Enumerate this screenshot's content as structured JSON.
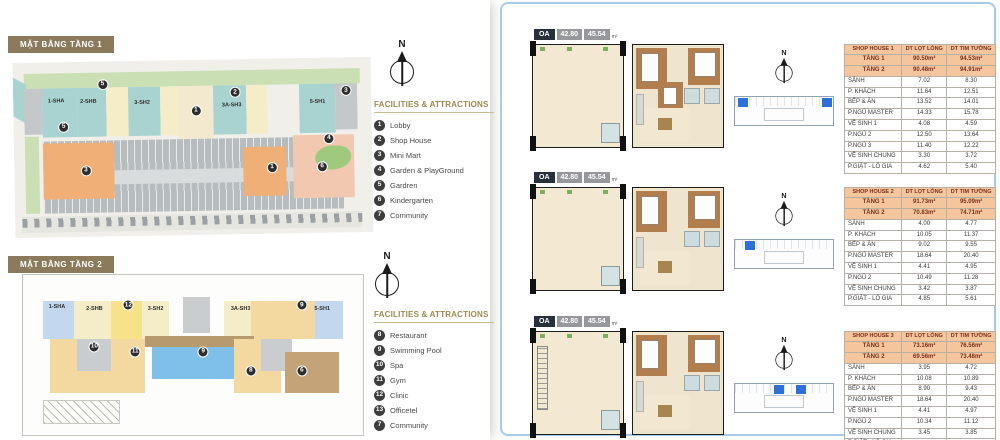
{
  "left_panel": {
    "floor1": {
      "title": "MẶT BẰNG TẦNG 1",
      "legend_title": "FACILITIES & ATTRACTIONS",
      "compass_label": "N",
      "items": [
        {
          "num": "1",
          "label": "Lobby"
        },
        {
          "num": "2",
          "label": "Shop House"
        },
        {
          "num": "3",
          "label": "Mini Mart"
        },
        {
          "num": "4",
          "label": "Garden & PlayGround"
        },
        {
          "num": "5",
          "label": "Gardren"
        },
        {
          "num": "6",
          "label": "Kindergarten"
        },
        {
          "num": "7",
          "label": "Community"
        }
      ],
      "unit_labels": [
        {
          "label": "1-SHA",
          "x": 12,
          "y": 22
        },
        {
          "label": "2-SHB",
          "x": 21,
          "y": 23
        },
        {
          "label": "3-SH2",
          "x": 36,
          "y": 24
        },
        {
          "label": "3A-SH3",
          "x": 61,
          "y": 26
        },
        {
          "label": "5-SH1",
          "x": 85,
          "y": 25
        }
      ],
      "markers": [
        {
          "n": "5",
          "x": 25,
          "y": 13
        },
        {
          "n": "2",
          "x": 62,
          "y": 19
        },
        {
          "n": "3",
          "x": 93,
          "y": 19
        },
        {
          "n": "1",
          "x": 51,
          "y": 29
        },
        {
          "n": "5",
          "x": 14,
          "y": 37
        },
        {
          "n": "3",
          "x": 20,
          "y": 62
        },
        {
          "n": "1",
          "x": 72,
          "y": 62
        },
        {
          "n": "4",
          "x": 88,
          "y": 46
        },
        {
          "n": "6",
          "x": 86,
          "y": 62
        }
      ]
    },
    "floor2": {
      "title": "MẶT BẰNG TẦNG 2",
      "legend_title": "FACILITIES & ATTRACTIONS",
      "compass_label": "N",
      "items": [
        {
          "num": "8",
          "label": "Restaurant"
        },
        {
          "num": "9",
          "label": "Swimming Pool"
        },
        {
          "num": "10",
          "label": "Spa"
        },
        {
          "num": "11",
          "label": "Gym"
        },
        {
          "num": "12",
          "label": "Clinic"
        },
        {
          "num": "13",
          "label": "Officetel"
        },
        {
          "num": "7",
          "label": "Community"
        }
      ],
      "unit_labels": [
        {
          "label": "1-SHA",
          "x": 10,
          "y": 20
        },
        {
          "label": "2-SHB",
          "x": 21,
          "y": 21
        },
        {
          "label": "3-SH2",
          "x": 39,
          "y": 21
        },
        {
          "label": "3A-SH3",
          "x": 64,
          "y": 21
        },
        {
          "label": "5-SH1",
          "x": 88,
          "y": 21
        }
      ],
      "markers": [
        {
          "n": "12",
          "x": 31,
          "y": 19
        },
        {
          "n": "9",
          "x": 82,
          "y": 19
        },
        {
          "n": "10",
          "x": 21,
          "y": 45
        },
        {
          "n": "11",
          "x": 33,
          "y": 48
        },
        {
          "n": "9",
          "x": 53,
          "y": 48
        },
        {
          "n": "8",
          "x": 67,
          "y": 60
        },
        {
          "n": "6",
          "x": 82,
          "y": 60
        }
      ]
    }
  },
  "right_panel": {
    "rows": [
      {
        "badge": {
          "code": "OA",
          "area_1": "42.80",
          "area_2": "45.54",
          "unit": "m²"
        },
        "compass_label": "N",
        "keyplan_highlights": [
          3,
          89
        ],
        "table": {
          "header": [
            "SHOP HOUSE 1",
            "DT LỌT LÒNG",
            "DT TIM TƯỜNG"
          ],
          "floor_rows": [
            [
              "TẦNG 1",
              "90.50m²",
              "94.53m²"
            ],
            [
              "TẦNG 2",
              "90.48m²",
              "94.91m²"
            ]
          ],
          "rows": [
            [
              "SẢNH",
              "7.02",
              "8.30"
            ],
            [
              "P. KHÁCH",
              "11.64",
              "12.51"
            ],
            [
              "BẾP & ĂN",
              "13.52",
              "14.01"
            ],
            [
              "P.NGỦ MASTER",
              "14.33",
              "15.78"
            ],
            [
              "VỆ SINH 1",
              "4.08",
              "4.59"
            ],
            [
              "P.NGỦ 2",
              "12.50",
              "13.64"
            ],
            [
              "P.NGỦ 3",
              "11.40",
              "12.22"
            ],
            [
              "VỆ SINH CHUNG",
              "3.30",
              "3.72"
            ],
            [
              "P.GIẶT - LÔ GIA",
              "4.62",
              "5.40"
            ]
          ]
        }
      },
      {
        "badge": {
          "code": "OA",
          "area_1": "42.80",
          "area_2": "45.54",
          "unit": "m²"
        },
        "compass_label": "N",
        "keyplan_highlights": [
          10
        ],
        "table": {
          "header": [
            "SHOP HOUSE 2",
            "DT LỌT LÒNG",
            "DT TIM TƯỜNG"
          ],
          "floor_rows": [
            [
              "TẦNG 1",
              "91.73m²",
              "95.09m²"
            ],
            [
              "TẦNG 2",
              "70.83m²",
              "74.71m²"
            ]
          ],
          "rows": [
            [
              "SẢNH",
              "4.00",
              "4.77"
            ],
            [
              "P. KHÁCH",
              "10.05",
              "11.37"
            ],
            [
              "BẾP & ĂN",
              "9.02",
              "9.55"
            ],
            [
              "P.NGỦ MASTER",
              "18.64",
              "20.40"
            ],
            [
              "VỆ SINH 1",
              "4.41",
              "4.95"
            ],
            [
              "P.NGỦ 2",
              "10.49",
              "11.28"
            ],
            [
              "VỆ SINH CHUNG",
              "3.42",
              "3.87"
            ],
            [
              "P.GIẶT - LÔ GIA",
              "4.85",
              "5.61"
            ]
          ]
        }
      },
      {
        "badge": {
          "code": "OA",
          "area_1": "42.80",
          "area_2": "45.54",
          "unit": "m²"
        },
        "compass_label": "N",
        "keyplan_highlights": [
          40,
          62
        ],
        "table": {
          "header": [
            "SHOP HOUSE 3",
            "DT LỌT LÒNG",
            "DT TIM TƯỜNG"
          ],
          "floor_rows": [
            [
              "TẦNG 1",
              "73.16m²",
              "76.56m²"
            ],
            [
              "TẦNG 2",
              "69.56m²",
              "73.48m²"
            ]
          ],
          "rows": [
            [
              "SẢNH",
              "3.95",
              "4.72"
            ],
            [
              "P. KHÁCH",
              "10.08",
              "10.89"
            ],
            [
              "BẾP & ĂN",
              "8.90",
              "9.43"
            ],
            [
              "P.NGỦ MASTER",
              "18.64",
              "20.40"
            ],
            [
              "VỆ SINH 1",
              "4.41",
              "4.97"
            ],
            [
              "P.NGỦ 2",
              "10.34",
              "11.12"
            ],
            [
              "VỆ SINH CHUNG",
              "3.45",
              "3.85"
            ],
            [
              "P.GIẶT - LÔ GIA",
              "4.65",
              "5.39"
            ]
          ]
        }
      }
    ]
  }
}
